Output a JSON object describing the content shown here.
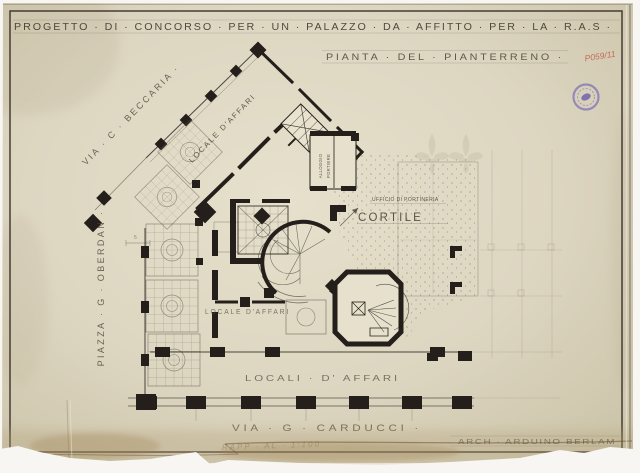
{
  "document": {
    "title": "PROGETTO · DI · CONCORSO · PER · UN · PALAZZO · DA · AFFITTO · PER · LA · R.A.S ·",
    "subtitle": "PIANTA · DEL · PIANTERRENO ·",
    "archive_mark": "P059/11",
    "signature": "ARCH · ARDUINO BERLAM",
    "scale_note": "RAPP · AL · 1:100"
  },
  "plan_labels": {
    "street_top_diagonal": "VIA · C · BECCARIA ·",
    "street_left_vertical": "PIAZZA · G · OBERDAN ·",
    "street_bottom": "VIA · G · CARDUCCI ·",
    "courtyard": "CORTILE",
    "porter_office_note": "UFFICIO DI PORTINERIA",
    "porter_lodging_line1": "ALLOGGIO",
    "porter_lodging_line2": "PORTIERE",
    "business_wing_diagonal": "LOCALE D'AFFARI",
    "business_hall_center": "LOCALE D'AFFARI",
    "business_wing_bottom": "LOCALI · D' AFFARI",
    "dimension_note": "5"
  },
  "colors": {
    "paper": "#d9d2bb",
    "ink": "#241f1a",
    "pencil": "#6b6154",
    "stamp_purple": "#7f72b8",
    "archive_mark_red": "#c05a49",
    "scan_background": "#f7f6f2"
  }
}
